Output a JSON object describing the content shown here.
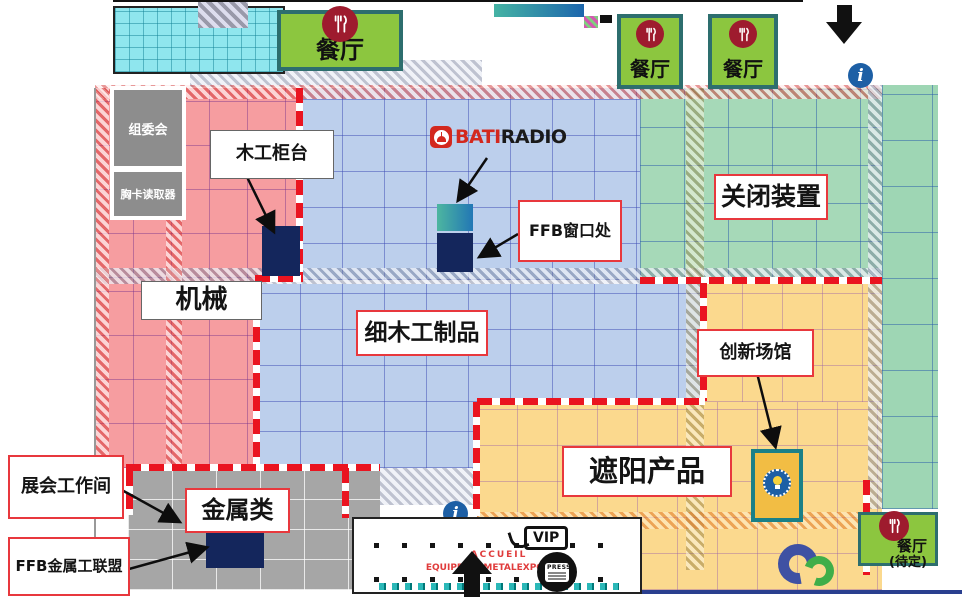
{
  "page": {
    "type": "exhibition-floor-plan"
  },
  "zones": {
    "machinery": {
      "label": "机械",
      "fill": "#f69da0"
    },
    "joinery": {
      "label": "细木工制品",
      "fill": "#bccfec"
    },
    "closing_devices": {
      "label": "关闭装置",
      "fill": "#a6d9b8"
    },
    "sun_protection": {
      "label": "遮阳产品",
      "fill": "#fbd98e"
    },
    "metal": {
      "label": "金属类",
      "fill": "#a6a6a6"
    }
  },
  "callouts": {
    "woodworking_counter": "木工柜台",
    "ffb_window": "FFB窗口处",
    "innovation_hall": "创新场馆",
    "exhibition_workshop": "展会工作间",
    "ffb_metal_alliance": "FFB金属工联盟"
  },
  "facilities": {
    "organizing_committee": "组委会",
    "badge_reader": "胸卡读取器",
    "restaurant": "餐厅",
    "restaurant_pending": "(待定)"
  },
  "brand": {
    "bati": "BATI",
    "radio": "RADIO"
  },
  "entrance": {
    "accueil": "ACCUEIL",
    "event": "EQUIPBAIE METALEXPO 2018",
    "vip": "VIP",
    "press": "PRESS"
  },
  "colors": {
    "boundary_red": "#ea1420",
    "highlight_navy": "#14265c",
    "restaurant_green": "#8cc63f",
    "icon_dark_red": "#9e1b2e",
    "info_blue": "#1d5fa5",
    "innovation_teal": "#1b8087",
    "gradient_teal": "#45b3a4",
    "gradient_blue": "#1c66ad"
  }
}
